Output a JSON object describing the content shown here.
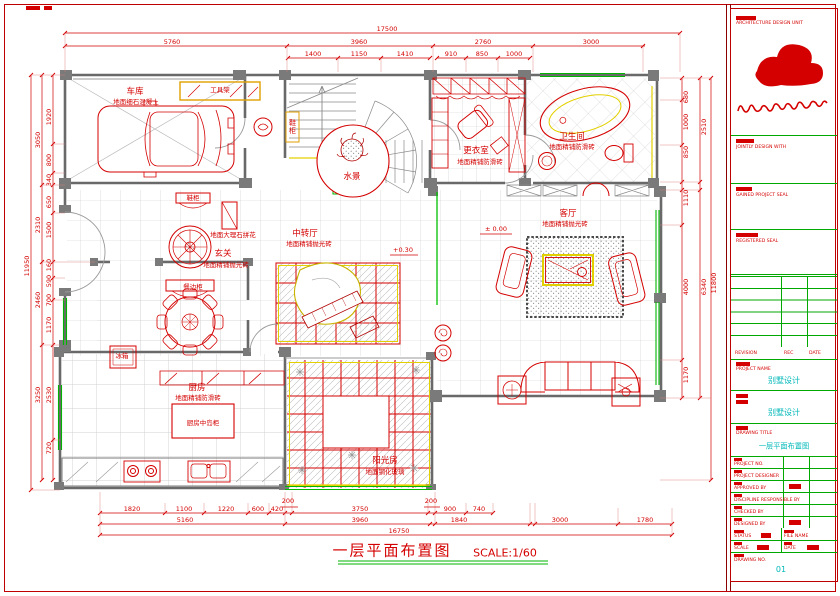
{
  "colors": {
    "red": "#d40000",
    "green": "#00a800",
    "cyan": "#00b8b8",
    "yellow": "#e3d000",
    "wall_gray": "#7a7a7a"
  },
  "plan": {
    "caption_title": "一层平面布置图",
    "caption_scale": "SCALE:1/60",
    "rooms": {
      "garage": "车库",
      "garage_floor": "地面细石混凝土",
      "tool_rack": "工具架",
      "water": "水景",
      "dressing": "更衣室",
      "dressing_floor": "地面精铺防滑砖",
      "bath": "卫生间",
      "bath_floor": "地面精铺防滑砖",
      "shoe1": "鞋柜",
      "shoe2": "鞋柜",
      "medallion": "地面大理石拼花",
      "foyer": "玄关",
      "foyer_floor": "地面精铺抛光砖",
      "hall": "中转厅",
      "hall_floor": "地面精铺抛光砖",
      "living": "客厅",
      "living_floor": "地面精铺抛光砖",
      "sideboard": "餐边柜",
      "fridge": "冰箱",
      "kitchen": "厨房",
      "kitchen_floor": "地面精铺防滑砖",
      "island": "厨房中岛柜",
      "sunroom": "阳光房",
      "sunroom_floor": "地面钢化玻璃"
    },
    "elev_hall": "+0.30",
    "elev_living": "± 0.00",
    "dims": {
      "top": {
        "overall": "17500",
        "seg": [
          "5760",
          "3960",
          "2760",
          "3000"
        ],
        "sub": [
          "1400",
          "1150",
          "1410",
          "910",
          "850",
          "1000"
        ]
      },
      "bottom": {
        "small": [
          "200",
          "200"
        ],
        "sub": [
          "1820",
          "1100",
          "1220",
          "600",
          "420",
          "3750",
          "900",
          "740"
        ],
        "seg": [
          "5160",
          "3960",
          "1840",
          "3000",
          "1780"
        ],
        "overall": "16750"
      },
      "left": {
        "overall": "11950",
        "seg": [
          "3050",
          "2310",
          "2460",
          "3250"
        ],
        "sub": [
          "1920",
          "800",
          "340",
          "650",
          "1500",
          "160",
          "590",
          "700",
          "1170",
          "2530",
          "720"
        ]
      },
      "right": {
        "overall": "11800",
        "seg": [
          "2510",
          "6340"
        ],
        "sub": [
          "680",
          "1000",
          "850",
          "1110",
          "4000",
          "1170"
        ]
      }
    }
  },
  "titleblock": {
    "unit": "ARCHITECTURE DESIGN UNIT",
    "jointly": "JOINTLY DESIGN WITH",
    "seal": "GAINED PROJECT SEAL",
    "registered": "REGISTERED SEAL",
    "rev": "REVISION",
    "rec": "REC",
    "date": "DATE",
    "pname_label": "PROJECT NAME",
    "pname": "别墅设计",
    "sname": "别墅设计",
    "dtitle_label": "DRAWING TITLE",
    "dtitle": "一层平面布置图",
    "rows": [
      "PROJECT NO.",
      "PROJECT DESIGNER",
      "APPROVED BY",
      "DISCIPLINE RESPONSIBLE BY",
      "CHECKED BY",
      "DESIGNED BY"
    ],
    "status": "STATUS",
    "file": "FILE NAME",
    "scale": "SCALE",
    "date2": "DATE",
    "dno_label": "DRAWING NO.",
    "dno": "01"
  }
}
